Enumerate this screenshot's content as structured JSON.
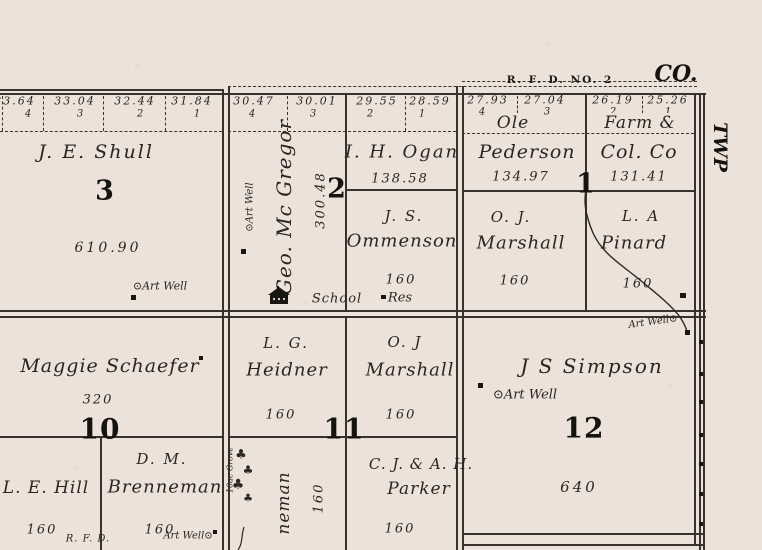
{
  "labels": {
    "county": "CO.",
    "township": "TWP",
    "rfd_route": "R. F. D. NO. 2",
    "rfd_bottom": "R. F. D."
  },
  "icons": {
    "well": "⊙",
    "tree": "♣"
  },
  "sections": {
    "s3": {
      "number": "3",
      "owner": "J. E. Shull",
      "acreage": "610.90",
      "art_well": "Art Well",
      "lots": [
        {
          "acres": "33.64",
          "no": "4"
        },
        {
          "acres": "33.04",
          "no": "3"
        },
        {
          "acres": "32.44",
          "no": "2"
        },
        {
          "acres": "31.84",
          "no": "1"
        }
      ]
    },
    "s2": {
      "number": "2",
      "lots": [
        {
          "acres": "30.47",
          "no": "4"
        },
        {
          "acres": "30.01",
          "no": "3"
        },
        {
          "acres": "29.55",
          "no": "2"
        },
        {
          "acres": "28.59",
          "no": "1"
        }
      ],
      "mcgregor": {
        "name": "Geo. Mc Gregor",
        "acres": "300.48",
        "art_well": "Art Well"
      },
      "ogan": {
        "name": "I. H. Ogan",
        "acres": "138.58"
      },
      "ommenson": {
        "line1": "J. S.",
        "line2": "Ommenson",
        "acres": "160"
      },
      "school": "School",
      "res": "Res"
    },
    "s1": {
      "number": "1",
      "lots": [
        {
          "acres": "27.93",
          "no": "4"
        },
        {
          "acres": "27.04",
          "no": "3"
        },
        {
          "acres": "26.19",
          "no": "2"
        },
        {
          "acres": "25.26",
          "no": "1"
        }
      ],
      "pederson": {
        "line1": "Ole",
        "line2": "Pederson",
        "acres": "134.97"
      },
      "farmcol": {
        "line1": "Farm &",
        "line2": "Col. Co",
        "acres": "131.41"
      },
      "marshall": {
        "line1": "O. J.",
        "line2": "Marshall",
        "acres": "160"
      },
      "pinard": {
        "line1": "L. A",
        "line2": "Pinard",
        "acres": "160"
      }
    },
    "s10": {
      "number": "10",
      "schaefer": {
        "name": "Maggie Schaefer",
        "acres": "320"
      },
      "hill": {
        "name": "L. E. Hill",
        "acres": "160"
      },
      "brenneman": {
        "line1": "D. M.",
        "line2": "Brenneman",
        "acres": "160",
        "art_well": "Art Well"
      }
    },
    "s11": {
      "number": "11",
      "heidner": {
        "line1": "L. G.",
        "line2": "Heidner",
        "acres": "160"
      },
      "marshall": {
        "line1": "O. J",
        "line2": "Marshall",
        "acres": "160"
      },
      "parker": {
        "line1": "C. J. & A. H.",
        "line2": "Parker",
        "acres": "160"
      },
      "brenneman_vert": {
        "name": "neman",
        "acres": "160"
      },
      "grove": "10ac Grove"
    },
    "s12": {
      "number": "12",
      "owner": "J S Simpson",
      "acres": "640",
      "art_well": "Art Well",
      "creek_well": "Art Well"
    }
  }
}
